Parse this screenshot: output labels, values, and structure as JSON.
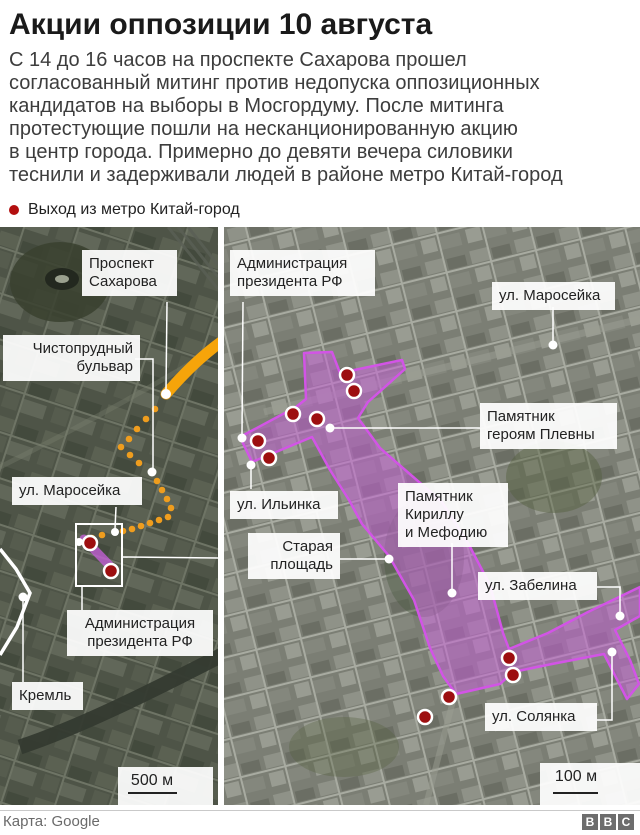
{
  "header": {
    "title": "Акции оппозиции 10 августа",
    "body": "С 14 до 16 часов на проспекте Сахарова прошел\nсогласованный митинг против недопуска оппозиционных\nкандидатов на выборы в Мосгордуму. После митинга\nпротестующие пошли на несканционированную акцию\nв центр города. Примерно до девяти вечера силовики\nтеснили и задерживали людей в районе метро Китай-город",
    "legend_label": "Выход из метро Китай-город"
  },
  "left_map": {
    "labels": {
      "prospekt": "Проспект\nСахарова",
      "chistoprudny": "Чистопрудный\nбульвар",
      "maroseyka": "ул. Маросейка",
      "admin": "Администрация\nпрезидента РФ",
      "kreml": "Кремль"
    },
    "scale": "500 м"
  },
  "right_map": {
    "labels": {
      "admin": "Администрация\nпрезидента РФ",
      "maroseyka": "ул. Маросейка",
      "plevna": "Памятник\nгероям Плевны",
      "ilyinka": "ул. Ильинка",
      "kirill": "Памятник\nКириллу\nи Мефодию",
      "staraya": "Старая\nплощадь",
      "zabelina": "ул. Забелина",
      "solyanka": "ул. Солянка"
    },
    "scale": "100 м"
  },
  "footer": {
    "credit": "Карта: Google",
    "logo": [
      "B",
      "B",
      "C"
    ]
  },
  "colors": {
    "metro_exit_red": "#9d0f10",
    "legend_red": "#b30f0f",
    "route_orange": "#f6a40a",
    "route_dot_orange": "#ef9d1e",
    "protest_area_fill": "#c260d4",
    "protest_area_border": "#d254e6"
  }
}
